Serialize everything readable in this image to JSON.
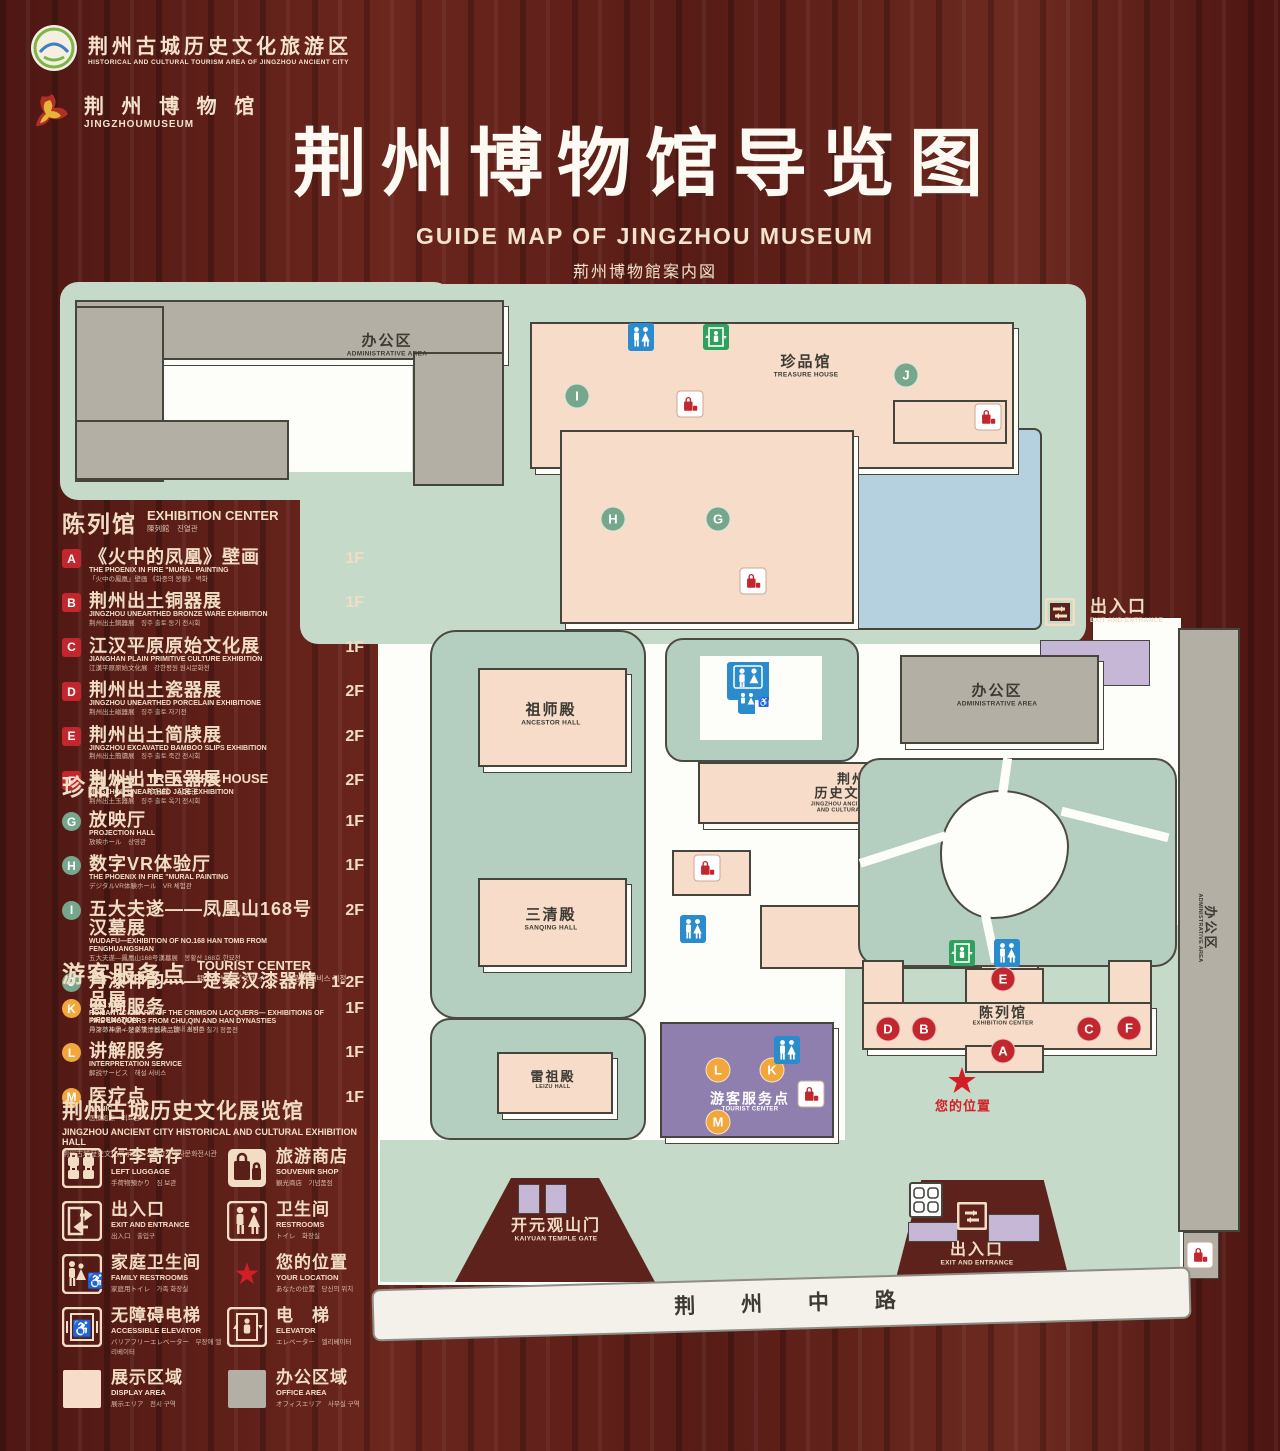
{
  "header": {
    "logo1": {
      "title": "荆州古城历史文化旅游区",
      "subtitle": "HISTORICAL AND CULTURAL TOURISM AREA OF JINGZHOU ANCIENT CITY"
    },
    "logo2": {
      "title": "荆 州 博 物 馆",
      "subtitle": "JINGZHOUMUSEUM"
    },
    "title": "荆州博物馆导览图",
    "subtitle_en": "GUIDE MAP OF JINGZHOU MUSEUM",
    "subtitle_ja": "荊州博物館案内図",
    "subtitle_ko": "징주박물관 안내도"
  },
  "legend": {
    "sections": [
      {
        "id": "exhibition-center",
        "badge": "sq",
        "title_zh": "陈列馆",
        "title_en": "EXHIBITION CENTER",
        "title_sub": "陳列館　진열관",
        "items": [
          {
            "key": "A",
            "zh": "《火中的凤凰》壁画",
            "en": "THE PHOENIX IN FIRE \"MURAL PAINTING",
            "sub": "「火中の鳳凰」壁画 《화중의 봉황》 벽화",
            "floor": "1F"
          },
          {
            "key": "B",
            "zh": "荆州出土铜器展",
            "en": "JINGZHOU UNEARTHED BRONZE WARE EXHIBITION",
            "sub": "荆州出土銅器展　징주 출토 동기 전시회",
            "floor": "1F"
          },
          {
            "key": "C",
            "zh": "江汉平原原始文化展",
            "en": "JIANGHAN PLAIN PRIMITIVE CULTURE EXHIBITION",
            "sub": "江漢平原原始文化展　강한평원 원시문화전",
            "floor": "1F"
          },
          {
            "key": "D",
            "zh": "荆州出土瓷器展",
            "en": "JINGZHOU UNEARTHED PORCELAIN EXHIBITIONE",
            "sub": "荆州出土磁器展　징주 출토 자기전",
            "floor": "2F"
          },
          {
            "key": "E",
            "zh": "荆州出土简牍展",
            "en": "JINGZHOU EXCAVATED BAMBOO SLIPS EXHIBITION",
            "sub": "荆州出土簡牘展　징주 출토 죽간 전시회",
            "floor": "2F"
          },
          {
            "key": "F",
            "zh": "荆州出土玉器展",
            "en": "JINGZHOU UNEARTHED JADE EXHIBITION",
            "sub": "荆州出土玉器展　징주 출토 옥기 전시회",
            "floor": "2F"
          }
        ]
      },
      {
        "id": "treasure-house",
        "badge": "gr",
        "title_zh": "珍品馆",
        "title_en": "TREASURE HOUSE",
        "title_sub": "珍品館　진품관",
        "items": [
          {
            "key": "G",
            "zh": "放映厅",
            "en": "PROJECTION HALL",
            "sub": "放映ホール　상영관",
            "floor": "1F"
          },
          {
            "key": "H",
            "zh": "数字VR体验厅",
            "en": "THE PHOENIX IN FIRE \"MURAL PAINTING",
            "sub": "デジタルVR体験ホール　VR 체험관",
            "floor": "1F"
          },
          {
            "key": "I",
            "zh": "五大夫遂——凤凰山168号汉墓展",
            "en": "WUDAFU—EXHIBITION OF NO.168 HAN TOMB FROM FENGHUANGSHAN",
            "sub": "五大夫遂—鳳凰山168号漢墓展　봉황산 168호 한묘전",
            "floor": "2F"
          },
          {
            "key": "J",
            "zh": "丹漆神韵——楚秦汉漆器精品展",
            "en": "ROMANTIC CHARM OF THE CRIMSON LACQUERS— EXHIBITIONS OF FINE LACQUERS FROM CHU,QIN AND HAN DYNASTIES",
            "sub": "丹漆の神韻—楚秦漢漆器精品展　초진한 칠기 정품전",
            "floor": "1-2F"
          }
        ]
      },
      {
        "id": "tourist-center",
        "badge": "yl",
        "title_zh": "游客服务点",
        "title_en": "TOURIST CENTER",
        "title_sub": "観光客サービスポイント　관광객 서비스 지점",
        "items": [
          {
            "key": "K",
            "zh": "咨询服务",
            "en": "INFORMATION",
            "sub": "コンサルティングサービス　안내 서비스",
            "floor": "1F"
          },
          {
            "key": "L",
            "zh": "讲解服务",
            "en": "INTERPRETATION SERVICE",
            "sub": "解説サービス　해설 서비스",
            "floor": "1F"
          },
          {
            "key": "M",
            "zh": "医疗点",
            "en": "CLINIC",
            "sub": "医療処点　의료점",
            "floor": "1F"
          }
        ]
      }
    ],
    "hall_note": {
      "zh": "荆州古城历史文化展览馆",
      "en": "JINGZHOU ANCIENT CITY HISTORICAL AND CULTURAL EXHIBITION HALL",
      "sub": "荆州古城歴史文化展示館　징주고성역사문화전시관"
    },
    "icons": [
      {
        "icon": "left-luggage",
        "zh": "行李寄存",
        "en": "LEFT LUGGAGE",
        "sub": "手荷物預かり　짐 보관"
      },
      {
        "icon": "souvenir-shop",
        "zh": "旅游商店",
        "en": "SOUVENIR SHOP",
        "sub": "観光商店　기념품점"
      },
      {
        "icon": "exit-entrance",
        "zh": "出入口",
        "en": "EXIT AND ENTRANCE",
        "sub": "出入口　출입구"
      },
      {
        "icon": "restrooms",
        "zh": "卫生间",
        "en": "RESTROOMS",
        "sub": "トイレ　화장실"
      },
      {
        "icon": "family-restrooms",
        "zh": "家庭卫生间",
        "en": "FAMILY RESTROOMS",
        "sub": "家庭用トイレ　가족 화장실"
      },
      {
        "icon": "your-location",
        "zh": "您的位置",
        "en": "YOUR LOCATION",
        "sub": "あなたの位置　당신의 위치"
      },
      {
        "icon": "accessible-elevator",
        "zh": "无障碍电梯",
        "en": "ACCESSIBLE ELEVATOR",
        "sub": "バリアフリーエレベーター　무장애 엘리베이터"
      },
      {
        "icon": "elevator",
        "zh": "电　梯",
        "en": "ELEVATOR",
        "sub": "エレベーター　엘리베이터"
      },
      {
        "icon": "display-area",
        "zh": "展示区域",
        "en": "DISPLAY AREA",
        "sub": "展示エリア　전시 구역"
      },
      {
        "icon": "office-area",
        "zh": "办公区域",
        "en": "OFFICE AREA",
        "sub": "オフィスエリア　사무실 구역"
      }
    ]
  },
  "map": {
    "labels": {
      "admin": {
        "zh": "办公区",
        "en": "ADMINISTRATIVE AREA"
      },
      "treasure": {
        "zh": "珍品馆",
        "en": "TREASURE HOUSE"
      },
      "ancestor": {
        "zh": "祖师殿",
        "en": "ANCESTOR HALL"
      },
      "sanqing": {
        "zh": "三清殿",
        "en": "SANQING HALL"
      },
      "leizu": {
        "zh": "雷祖殿",
        "en": "LEIZU HALL"
      },
      "jzhall": {
        "zh1": "荆州古城",
        "zh2": "历史文化展览馆",
        "en1": "JINGZHOU ANCIENT CITY HISTORICAL",
        "en2": "AND CULTURAL EXHIBITION HALL"
      },
      "tourist": {
        "zh": "游客服务点",
        "en": "TOURIST CENTER"
      },
      "exhibition": {
        "zh": "陈列馆",
        "en": "EXHIBITION CENTER"
      },
      "exit": {
        "zh": "出入口",
        "en": "EXIT AND ENTRANCE"
      },
      "kaiyuan": {
        "zh": "开元观山门",
        "en": "KAIYUAN TEMPLE GATE"
      },
      "your_location": "您的位置",
      "road": "荆 州 中 路"
    },
    "markers": [
      {
        "kind": "green",
        "letter": "I",
        "x": 577,
        "y": 396
      },
      {
        "kind": "green",
        "letter": "J",
        "x": 906,
        "y": 375
      },
      {
        "kind": "green",
        "letter": "H",
        "x": 613,
        "y": 519
      },
      {
        "kind": "green",
        "letter": "G",
        "x": 718,
        "y": 519
      },
      {
        "kind": "red",
        "letter": "D",
        "x": 888,
        "y": 1029
      },
      {
        "kind": "red",
        "letter": "B",
        "x": 924,
        "y": 1029
      },
      {
        "kind": "red",
        "letter": "E",
        "x": 1003,
        "y": 979
      },
      {
        "kind": "red",
        "letter": "A",
        "x": 1003,
        "y": 1051
      },
      {
        "kind": "red",
        "letter": "C",
        "x": 1089,
        "y": 1029
      },
      {
        "kind": "red",
        "letter": "F",
        "x": 1129,
        "y": 1028
      },
      {
        "kind": "yellow",
        "letter": "L",
        "x": 718,
        "y": 1070
      },
      {
        "kind": "yellow",
        "letter": "K",
        "x": 772,
        "y": 1070
      },
      {
        "kind": "yellow",
        "letter": "M",
        "x": 718,
        "y": 1122
      },
      {
        "kind": "shop",
        "x": 690,
        "y": 404
      },
      {
        "kind": "shop",
        "x": 988,
        "y": 417
      },
      {
        "kind": "shop",
        "x": 753,
        "y": 581
      },
      {
        "kind": "shop",
        "x": 707,
        "y": 868
      },
      {
        "kind": "shop",
        "x": 811,
        "y": 1094
      },
      {
        "kind": "shop",
        "x": 1200,
        "y": 1255
      },
      {
        "kind": "wc",
        "x": 641,
        "y": 337
      },
      {
        "kind": "wc",
        "x": 693,
        "y": 929
      },
      {
        "kind": "wc",
        "x": 787,
        "y": 1050
      },
      {
        "kind": "wc",
        "x": 1007,
        "y": 953
      },
      {
        "kind": "wcfam",
        "x": 748,
        "y": 688
      },
      {
        "kind": "lift",
        "x": 716,
        "y": 337
      },
      {
        "kind": "lift",
        "x": 962,
        "y": 953
      },
      {
        "kind": "locker",
        "x": 926,
        "y": 1200
      },
      {
        "kind": "exit",
        "x": 1060,
        "y": 612
      },
      {
        "kind": "exit",
        "x": 972,
        "y": 1216
      },
      {
        "kind": "star",
        "x": 962,
        "y": 1081
      }
    ]
  },
  "colors": {
    "wood": "#5b1f19",
    "ground": "#c6dac9",
    "courtyard": "#b4cebf",
    "display_area": "#f6dcc9",
    "office_area": "#b3afa5",
    "pond": "#b5d0de",
    "tourist_purple": "#8f7fae",
    "gate_purple": "#c6b7d6",
    "marker_red": "#c2272d",
    "marker_green": "#76a78c",
    "marker_yellow": "#f2a73d",
    "sign_blue": "#2a8ccc",
    "sign_green": "#2ea15e",
    "cream": "#f0ddc4"
  }
}
